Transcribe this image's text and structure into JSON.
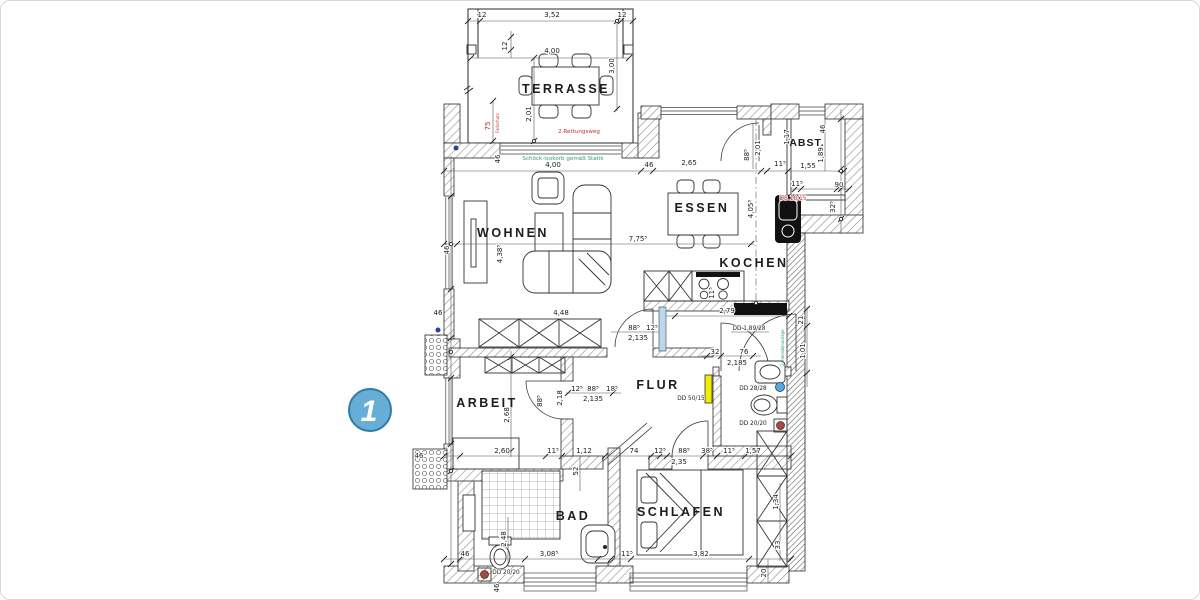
{
  "marker": {
    "number": "1"
  },
  "rooms": {
    "terrasse": "TERRASSE",
    "wohnen": "WOHNEN",
    "essen": "ESSEN",
    "kochen": "KOCHEN",
    "abst": "ABST.",
    "arbeit": "ARBEIT",
    "flur": "FLUR",
    "bad": "BAD",
    "schlafen": "SCHLAFEN"
  },
  "notes": {
    "rescue_route": "2.Rettungsweg",
    "isokorb": "Schöck-Isokorb gemäß Statik",
    "fall_protection": "Fallschutz",
    "wardrobe": "Garderobenanlage"
  },
  "openings": {
    "db_18_15": "DB 18/15",
    "dd_189_28": "DD 1,89/28",
    "dd_50_15": "DD 50/15",
    "dd_28_28": "DD 28/28",
    "dd_20_20_wc": "DD 20/20",
    "dd_20_20_bad": "DD 20/20"
  },
  "dims": [
    "12",
    "3,52",
    "12",
    "12",
    "4,00",
    "3,00",
    "2,01",
    "75",
    "46",
    "4,00",
    "46",
    "2,65",
    "11⁵",
    "1,55",
    "46",
    "1,17",
    "1,89",
    "11⁵",
    "90",
    "32⁵",
    "46",
    "4,38⁵",
    "7,75⁵",
    "4,05⁵",
    "2,01",
    "88⁵",
    "2,79",
    "11⁵",
    "21",
    "1,01",
    "88⁵",
    "12⁵",
    "2,135",
    "32",
    "76",
    "2,185",
    "12⁵",
    "88⁵",
    "18⁵",
    "2,135",
    "88⁵",
    "2,18",
    "46",
    "46",
    "2,68",
    "2,60",
    "11⁵",
    "1,12",
    "52",
    "74",
    "12⁵",
    "88⁵",
    "38⁵",
    "2,35",
    "11⁵",
    "1,57",
    "2,48",
    "46",
    "3,08⁵",
    "11⁵",
    "3,82",
    "1,34",
    "33",
    "20",
    "46",
    "4,48"
  ],
  "colors": {
    "marker_fill": "#66aed5",
    "marker_border": "#2f7ca8",
    "annotation_red": "#c03030",
    "annotation_green": "#2e9a78",
    "shaft_yellow": "#f2ed00",
    "symbol_blue": "#58a8d8",
    "symbol_brown": "#9c4f43",
    "line": "#1c1c1c"
  }
}
